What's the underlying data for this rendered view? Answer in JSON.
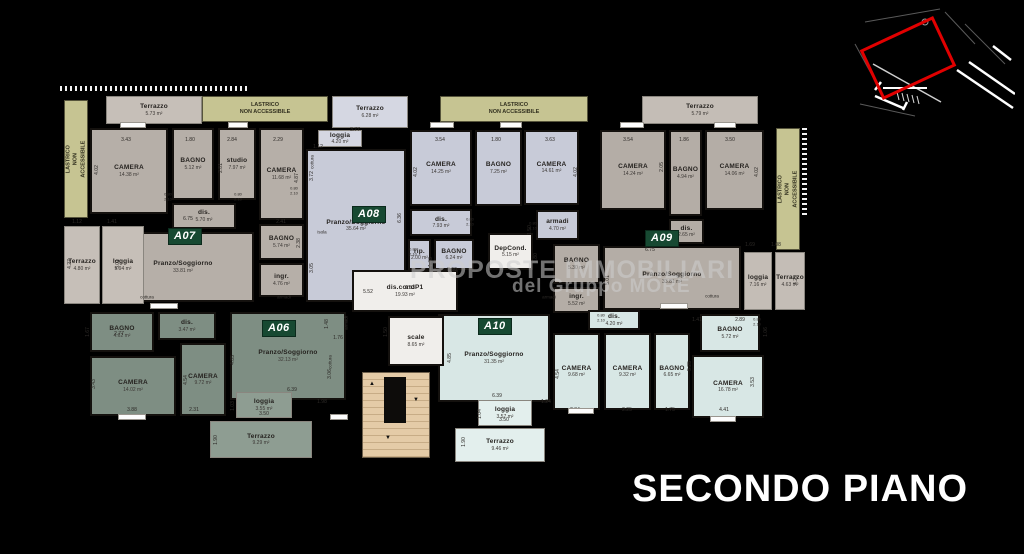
{
  "title": "SECONDO PIANO",
  "watermark": {
    "line1": "PROPOSTE IMMOBILIARI",
    "line2": "del Gruppo MORE"
  },
  "colors": {
    "background": "#000000",
    "a06": "#7e8e83",
    "a06_terrace": "#8e9d92",
    "a07": "#b6afa8",
    "a07_terrace": "#c6bfb8",
    "a08": "#c8cbd8",
    "a08_terrace": "#d5d7e2",
    "a09": "#b4ada6",
    "a09_terrace": "#c4bdb6",
    "a10": "#d8e7e5",
    "a10_terrace": "#e3efed",
    "common": "#f0eeeb",
    "lastrico": "#c6c492",
    "stairs": "#e4cba7",
    "badge": "#174932",
    "minimap_highlight": "#e10000"
  },
  "apartments": [
    {
      "id": "A07",
      "color": "#b6afa8",
      "terrace_color": "#c6bfb8",
      "badge": {
        "x": 168,
        "y": 228
      },
      "rooms": [
        {
          "label": "Terrazzo",
          "area": "5.73 m²",
          "x": 106,
          "y": 96,
          "w": 96,
          "h": 28,
          "t": 1
        },
        {
          "label": "CAMERA",
          "area": "14.38 m²",
          "x": 90,
          "y": 128,
          "w": 78,
          "h": 86
        },
        {
          "label": "BAGNO",
          "area": "5.12 m²",
          "x": 172,
          "y": 128,
          "w": 42,
          "h": 72
        },
        {
          "label": "studio",
          "area": "7.97 m²",
          "x": 218,
          "y": 128,
          "w": 38,
          "h": 72
        },
        {
          "label": "CAMERA",
          "area": "11.68 m²",
          "x": 259,
          "y": 128,
          "w": 45,
          "h": 92
        },
        {
          "label": "dis.",
          "area": "5.70 m²",
          "x": 172,
          "y": 203,
          "w": 64,
          "h": 26
        },
        {
          "label": "Pranzo/Soggiorno",
          "area": "33.81 m²",
          "x": 112,
          "y": 232,
          "w": 142,
          "h": 70
        },
        {
          "label": "BAGNO",
          "area": "5.74 m²",
          "x": 259,
          "y": 224,
          "w": 45,
          "h": 36
        },
        {
          "label": "ingr.",
          "area": "4.76 m²",
          "x": 259,
          "y": 263,
          "w": 45,
          "h": 34
        },
        {
          "label": "Terrazzo",
          "area": "4.80 m²",
          "x": 64,
          "y": 226,
          "w": 36,
          "h": 78,
          "t": 1
        },
        {
          "label": "loggia",
          "area": "5.94 m²",
          "x": 102,
          "y": 226,
          "w": 42,
          "h": 78,
          "t": 1
        }
      ]
    },
    {
      "id": "A08",
      "color": "#c8cbd8",
      "terrace_color": "#d5d7e2",
      "badge": {
        "x": 352,
        "y": 206
      },
      "rooms": [
        {
          "label": "Terrazzo",
          "area": "6.28 m²",
          "x": 332,
          "y": 96,
          "w": 76,
          "h": 32,
          "t": 1
        },
        {
          "label": "loggia",
          "area": "4.20 m²",
          "x": 318,
          "y": 130,
          "w": 44,
          "h": 17,
          "t": 1
        },
        {
          "label": "Pranzo/Soggiorno",
          "area": "35.64 m²",
          "x": 306,
          "y": 149,
          "w": 100,
          "h": 153
        },
        {
          "label": "CAMERA",
          "area": "14.25 m²",
          "x": 410,
          "y": 130,
          "w": 62,
          "h": 76
        },
        {
          "label": "BAGNO",
          "area": "7.25 m²",
          "x": 475,
          "y": 130,
          "w": 47,
          "h": 76
        },
        {
          "label": "CAMERA",
          "area": "14.61 m²",
          "x": 524,
          "y": 130,
          "w": 55,
          "h": 75
        },
        {
          "label": "dis.",
          "area": "7.93 m²",
          "x": 410,
          "y": 209,
          "w": 62,
          "h": 27
        },
        {
          "label": "armadi",
          "area": "4.70 m²",
          "x": 536,
          "y": 210,
          "w": 43,
          "h": 30
        },
        {
          "label": "rip.",
          "area": "2.00 m²",
          "x": 408,
          "y": 239,
          "w": 23,
          "h": 31
        },
        {
          "label": "BAGNO",
          "area": "6.24 m²",
          "x": 434,
          "y": 239,
          "w": 40,
          "h": 31
        }
      ]
    },
    {
      "id": "A09",
      "color": "#b4ada6",
      "terrace_color": "#c4bdb6",
      "badge": {
        "x": 645,
        "y": 230
      },
      "rooms": [
        {
          "label": "Terrazzo",
          "area": "5.79 m²",
          "x": 642,
          "y": 96,
          "w": 116,
          "h": 28,
          "t": 1
        },
        {
          "label": "CAMERA",
          "area": "14.24 m²",
          "x": 600,
          "y": 130,
          "w": 66,
          "h": 80
        },
        {
          "label": "BAGNO",
          "area": "4.94 m²",
          "x": 669,
          "y": 130,
          "w": 33,
          "h": 86
        },
        {
          "label": "CAMERA",
          "area": "14.06 m²",
          "x": 705,
          "y": 130,
          "w": 59,
          "h": 80
        },
        {
          "label": "dis.",
          "area": "2.65 m²",
          "x": 669,
          "y": 219,
          "w": 35,
          "h": 25
        },
        {
          "label": "BAGNO",
          "area": "5.30 m²",
          "x": 553,
          "y": 244,
          "w": 47,
          "h": 40
        },
        {
          "label": "ingr.",
          "area": "5.52 m²",
          "x": 553,
          "y": 287,
          "w": 47,
          "h": 26
        },
        {
          "label": "Pranzo/Soggiorno",
          "area": "33.81 m²",
          "x": 603,
          "y": 246,
          "w": 138,
          "h": 64
        },
        {
          "label": "loggia",
          "area": "7.16 m²",
          "x": 744,
          "y": 252,
          "w": 28,
          "h": 58,
          "t": 1
        },
        {
          "label": "Terrazzo",
          "area": "4.63 m²",
          "x": 775,
          "y": 252,
          "w": 30,
          "h": 58,
          "t": 1
        }
      ]
    },
    {
      "id": "A06",
      "color": "#7e8e83",
      "terrace_color": "#8e9d92",
      "badge": {
        "x": 262,
        "y": 320
      },
      "rooms": [
        {
          "label": "BAGNO",
          "area": "4.62 m²",
          "x": 90,
          "y": 312,
          "w": 64,
          "h": 40
        },
        {
          "label": "dis.",
          "area": "3.47 m²",
          "x": 158,
          "y": 312,
          "w": 58,
          "h": 28
        },
        {
          "label": "CAMERA",
          "area": "14.02 m²",
          "x": 90,
          "y": 356,
          "w": 86,
          "h": 60
        },
        {
          "label": "CAMERA",
          "area": "9.72 m²",
          "x": 180,
          "y": 343,
          "w": 46,
          "h": 73
        },
        {
          "label": "Pranzo/Soggiorno",
          "area": "32.13 m²",
          "x": 230,
          "y": 312,
          "w": 116,
          "h": 88
        },
        {
          "label": "loggia",
          "area": "3.55 m²",
          "x": 236,
          "y": 392,
          "w": 56,
          "h": 26,
          "t": 1
        },
        {
          "label": "Terrazzo",
          "area": "9.29 m²",
          "x": 210,
          "y": 421,
          "w": 102,
          "h": 37,
          "t": 1
        }
      ]
    },
    {
      "id": "A10",
      "color": "#d8e7e5",
      "terrace_color": "#e3efed",
      "badge": {
        "x": 478,
        "y": 318
      },
      "rooms": [
        {
          "label": "dis.",
          "area": "4.20 m²",
          "x": 588,
          "y": 310,
          "w": 52,
          "h": 20
        },
        {
          "label": "Pranzo/Soggiorno",
          "area": "31.35 m²",
          "x": 438,
          "y": 314,
          "w": 112,
          "h": 88
        },
        {
          "label": "CAMERA",
          "area": "9.68 m²",
          "x": 553,
          "y": 333,
          "w": 47,
          "h": 77
        },
        {
          "label": "CAMERA",
          "area": "9.32 m²",
          "x": 604,
          "y": 333,
          "w": 47,
          "h": 77
        },
        {
          "label": "BAGNO",
          "area": "6.65 m²",
          "x": 654,
          "y": 333,
          "w": 36,
          "h": 77
        },
        {
          "label": "BAGNO",
          "area": "5.72 m²",
          "x": 700,
          "y": 314,
          "w": 60,
          "h": 38
        },
        {
          "label": "CAMERA",
          "area": "16.78 m²",
          "x": 692,
          "y": 355,
          "w": 72,
          "h": 63
        },
        {
          "label": "loggia",
          "area": "3.57 m²",
          "x": 478,
          "y": 400,
          "w": 54,
          "h": 26,
          "t": 1
        },
        {
          "label": "Terrazzo",
          "area": "9.46 m²",
          "x": 455,
          "y": 428,
          "w": 90,
          "h": 34,
          "t": 1
        }
      ]
    }
  ],
  "common": {
    "color": "#f0eeeb",
    "rooms": [
      {
        "label": "DepCond.",
        "area": "5.15 m²",
        "x": 488,
        "y": 233,
        "w": 45,
        "h": 37
      },
      {
        "label": "dis.condP1",
        "area": "19.93 m²",
        "x": 352,
        "y": 270,
        "w": 106,
        "h": 42
      },
      {
        "label": "scale",
        "area": "8.65 m²",
        "x": 388,
        "y": 316,
        "w": 56,
        "h": 50
      }
    ]
  },
  "lastrico": {
    "label": "LASTRICO\nNON ACCESSIBILE",
    "strips": [
      {
        "x": 64,
        "y": 100,
        "w": 24,
        "h": 118,
        "v": 1
      },
      {
        "x": 202,
        "y": 96,
        "w": 126,
        "h": 26
      },
      {
        "x": 440,
        "y": 96,
        "w": 148,
        "h": 26
      },
      {
        "x": 776,
        "y": 128,
        "w": 24,
        "h": 122,
        "v": 1
      }
    ]
  },
  "dimensions": [
    {
      "t": "3.43",
      "x": 126,
      "y": 140
    },
    {
      "t": "1.80",
      "x": 190,
      "y": 140
    },
    {
      "t": "2.84",
      "x": 232,
      "y": 140
    },
    {
      "t": "2.29",
      "x": 278,
      "y": 140
    },
    {
      "t": "4.02",
      "x": 97,
      "y": 170,
      "v": 1
    },
    {
      "t": "2.81",
      "x": 221,
      "y": 168,
      "v": 1
    },
    {
      "t": "4.87",
      "x": 297,
      "y": 178,
      "v": 1
    },
    {
      "t": "6.75",
      "x": 188,
      "y": 219
    },
    {
      "t": "5.01",
      "x": 118,
      "y": 264,
      "v": 1
    },
    {
      "t": "2.41",
      "x": 281,
      "y": 222
    },
    {
      "t": "2.38",
      "x": 299,
      "y": 243,
      "v": 1
    },
    {
      "t": "1.12",
      "x": 77,
      "y": 222
    },
    {
      "t": "1.41",
      "x": 112,
      "y": 222
    },
    {
      "t": "4.27",
      "x": 70,
      "y": 264,
      "v": 1
    },
    {
      "t": "1.12",
      "x": 318,
      "y": 147
    },
    {
      "t": "3.77",
      "x": 355,
      "y": 130
    },
    {
      "t": "3.72",
      "x": 312,
      "y": 176,
      "v": 1
    },
    {
      "t": "6.36",
      "x": 400,
      "y": 218,
      "v": 1
    },
    {
      "t": "3.05",
      "x": 312,
      "y": 268,
      "v": 1
    },
    {
      "t": "5.52",
      "x": 368,
      "y": 292
    },
    {
      "t": "3.54",
      "x": 440,
      "y": 140
    },
    {
      "t": "1.80",
      "x": 496,
      "y": 140
    },
    {
      "t": "4.02",
      "x": 416,
      "y": 172,
      "v": 1
    },
    {
      "t": "2.60",
      "x": 452,
      "y": 270
    },
    {
      "t": "1.63",
      "x": 431,
      "y": 262,
      "v": 1
    },
    {
      "t": "3.63",
      "x": 550,
      "y": 140
    },
    {
      "t": "4.02",
      "x": 576,
      "y": 172,
      "v": 1
    },
    {
      "t": "1.50",
      "x": 530,
      "y": 230,
      "v": 1
    },
    {
      "t": "1.80",
      "x": 536,
      "y": 258,
      "v": 1
    },
    {
      "t": "3.54",
      "x": 628,
      "y": 140
    },
    {
      "t": "1.86",
      "x": 684,
      "y": 140
    },
    {
      "t": "3.50",
      "x": 730,
      "y": 140
    },
    {
      "t": "2.05",
      "x": 662,
      "y": 167,
      "v": 1
    },
    {
      "t": "4.02",
      "x": 757,
      "y": 172,
      "v": 1
    },
    {
      "t": "6.75",
      "x": 650,
      "y": 250
    },
    {
      "t": "5.01",
      "x": 608,
      "y": 280,
      "v": 1
    },
    {
      "t": "1.69",
      "x": 750,
      "y": 245
    },
    {
      "t": "1.08",
      "x": 776,
      "y": 245
    },
    {
      "t": "4.29",
      "x": 796,
      "y": 280,
      "v": 1
    },
    {
      "t": "1.53",
      "x": 410,
      "y": 288
    },
    {
      "t": "1.50",
      "x": 386,
      "y": 332,
      "v": 1
    },
    {
      "t": "2.77",
      "x": 119,
      "y": 334
    },
    {
      "t": "1.67",
      "x": 88,
      "y": 332,
      "v": 1
    },
    {
      "t": "3.43",
      "x": 94,
      "y": 384,
      "v": 1
    },
    {
      "t": "3.88",
      "x": 132,
      "y": 410
    },
    {
      "t": "2.31",
      "x": 194,
      "y": 410
    },
    {
      "t": "4.54",
      "x": 186,
      "y": 380,
      "v": 1
    },
    {
      "t": "4.85",
      "x": 233,
      "y": 360,
      "v": 1
    },
    {
      "t": "6.39",
      "x": 292,
      "y": 390
    },
    {
      "t": "3.06",
      "x": 330,
      "y": 374,
      "v": 1
    },
    {
      "t": "1.98",
      "x": 322,
      "y": 402
    },
    {
      "t": "1.76",
      "x": 338,
      "y": 338
    },
    {
      "t": "1.48",
      "x": 327,
      "y": 324,
      "v": 1
    },
    {
      "t": "3.50",
      "x": 264,
      "y": 414
    },
    {
      "t": "1.03",
      "x": 233,
      "y": 406,
      "v": 1
    },
    {
      "t": "1.90",
      "x": 216,
      "y": 440,
      "v": 1
    },
    {
      "t": "4.85",
      "x": 450,
      "y": 358,
      "v": 1
    },
    {
      "t": "6.39",
      "x": 497,
      "y": 396
    },
    {
      "t": "4.54",
      "x": 558,
      "y": 374,
      "v": 1
    },
    {
      "t": "2.34",
      "x": 575,
      "y": 410
    },
    {
      "t": "2.25",
      "x": 627,
      "y": 410
    },
    {
      "t": "1.75",
      "x": 670,
      "y": 410
    },
    {
      "t": "5.25",
      "x": 690,
      "y": 366,
      "v": 1
    },
    {
      "t": "4.41",
      "x": 724,
      "y": 410
    },
    {
      "t": "2.89",
      "x": 740,
      "y": 320
    },
    {
      "t": "1.41",
      "x": 697,
      "y": 320
    },
    {
      "t": "1.06",
      "x": 766,
      "y": 332,
      "v": 1
    },
    {
      "t": "3.53",
      "x": 753,
      "y": 382,
      "v": 1
    },
    {
      "t": "1.24",
      "x": 546,
      "y": 402
    },
    {
      "t": "3.50",
      "x": 504,
      "y": 420
    },
    {
      "t": "1.04",
      "x": 480,
      "y": 414,
      "v": 1
    },
    {
      "t": "1.90",
      "x": 464,
      "y": 442,
      "v": 1
    }
  ],
  "small_labels": [
    {
      "t": "cottura",
      "x": 147,
      "y": 297
    },
    {
      "t": "armadi",
      "x": 284,
      "y": 297
    },
    {
      "t": "cottura",
      "x": 312,
      "y": 162,
      "v": 1
    },
    {
      "t": "isola",
      "x": 322,
      "y": 232
    },
    {
      "t": "armadi",
      "x": 549,
      "y": 297
    },
    {
      "t": "cottura",
      "x": 712,
      "y": 296
    },
    {
      "t": "cottura",
      "x": 330,
      "y": 362,
      "v": 1
    },
    {
      "t": "armadi",
      "x": 346,
      "y": 323,
      "v": 1
    }
  ],
  "door_tag": {
    "w": "0.80",
    "h": "2.10"
  },
  "door_tag_positions": [
    {
      "x": 168,
      "y": 197
    },
    {
      "x": 238,
      "y": 197
    },
    {
      "x": 294,
      "y": 191
    },
    {
      "x": 413,
      "y": 252
    },
    {
      "x": 470,
      "y": 222
    },
    {
      "x": 533,
      "y": 226
    },
    {
      "x": 601,
      "y": 318
    },
    {
      "x": 757,
      "y": 322
    }
  ]
}
